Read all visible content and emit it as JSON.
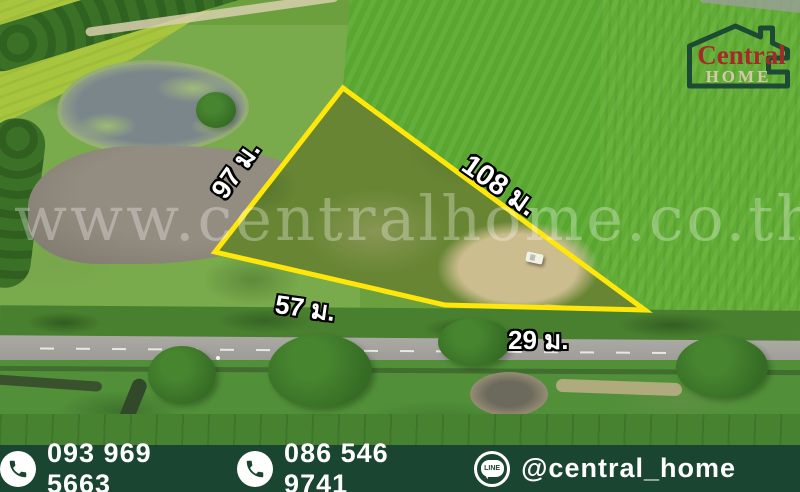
{
  "logo": {
    "brand": "Central",
    "home": "HOME"
  },
  "watermark": {
    "text": "www.centralhome.co.th"
  },
  "plot": {
    "side_left": "97 ม.",
    "side_right": "108 ม.",
    "side_bottom_left": "57 ม.",
    "side_bottom_right": "29 ม."
  },
  "footer": {
    "phone_1": "093 969 5663",
    "phone_2": "086 546 9741",
    "line_label": "LINE",
    "line_id": "@central_home"
  },
  "icons": {
    "phone": "phone-icon",
    "line": "line-icon",
    "logo_house": "house-logo-icon"
  },
  "colors": {
    "outline_yellow": "#ffe70a",
    "footer_green": "#1a4530",
    "logo_red": "#a32b28",
    "logo_beige": "#d6c9ab",
    "logo_green": "#1d4a34"
  }
}
